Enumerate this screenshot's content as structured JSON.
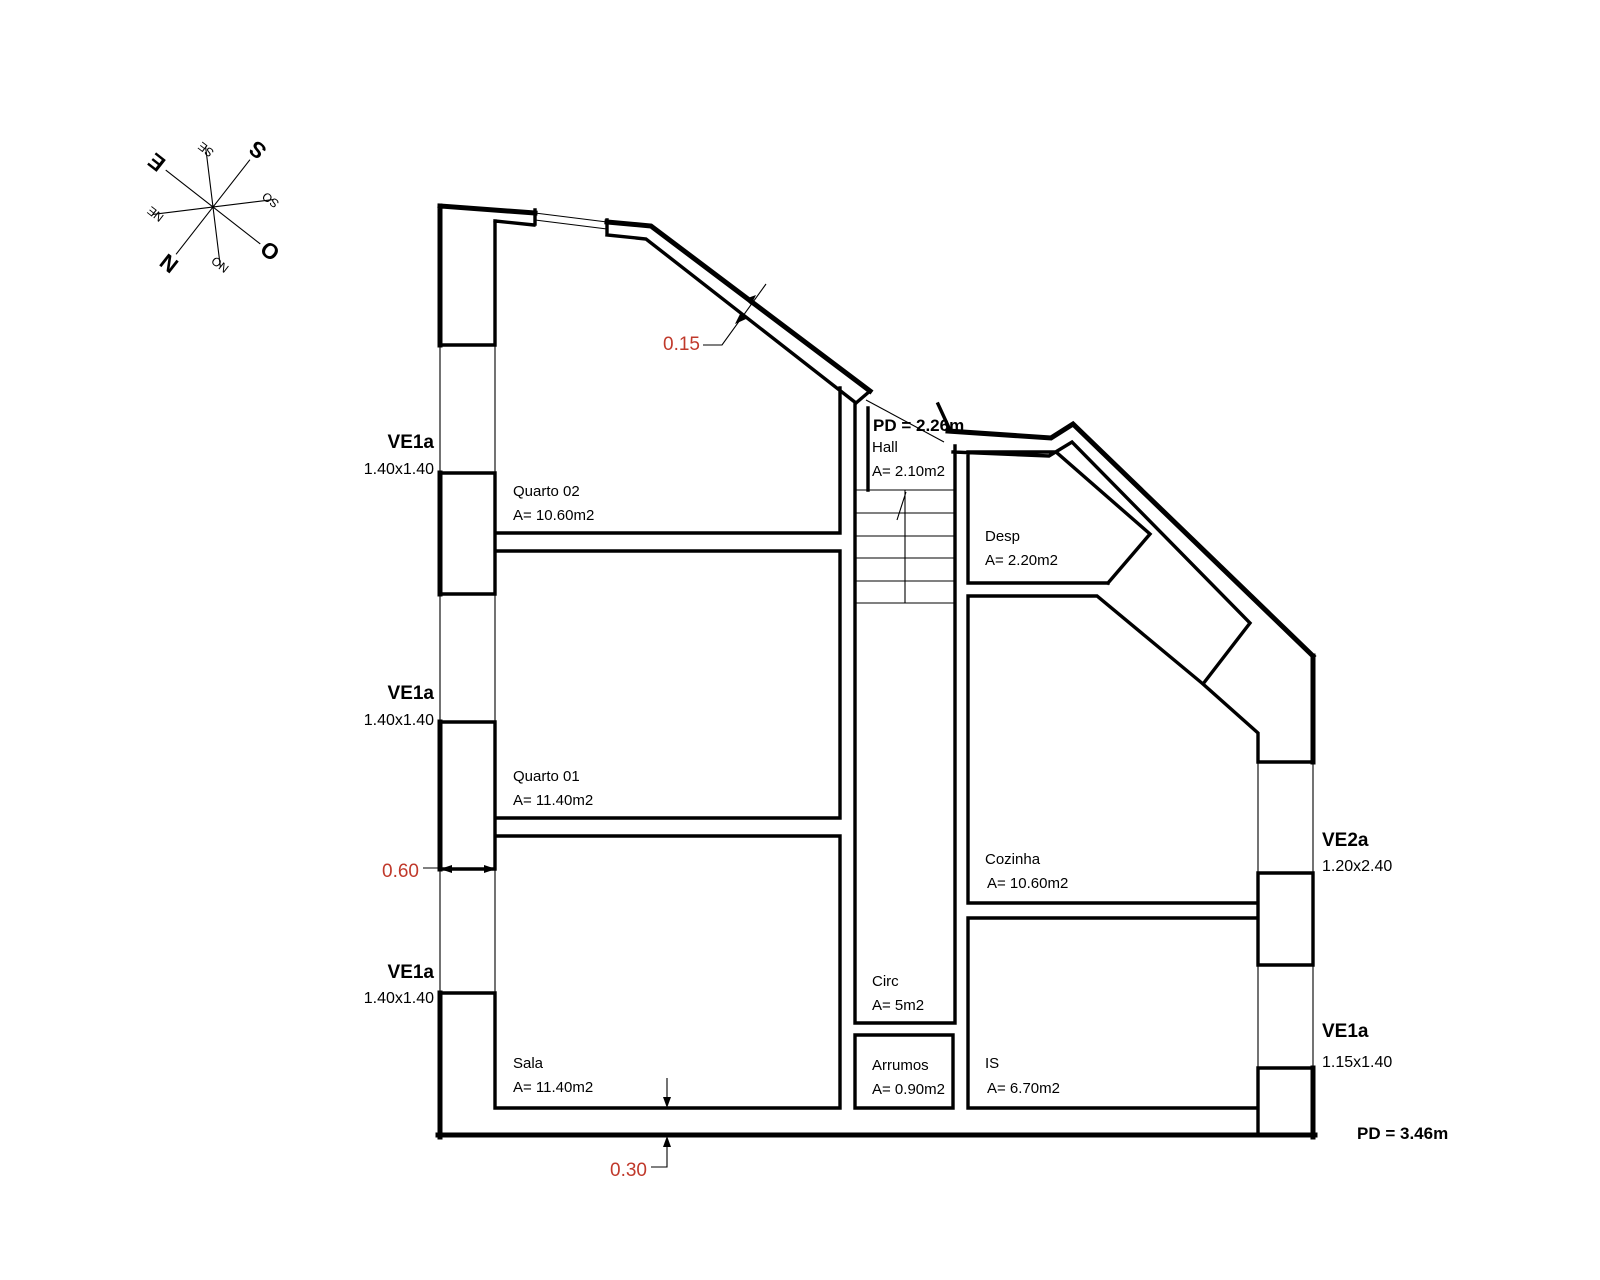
{
  "compass": {
    "n": "N",
    "ne": "NE",
    "e": "E",
    "se": "SE",
    "s": "S",
    "so": "SO",
    "o": "O",
    "no": "NO"
  },
  "rooms": [
    {
      "id": "quarto-02",
      "name": "Quarto 02",
      "area": "A= 10.60m2"
    },
    {
      "id": "quarto-01",
      "name": "Quarto 01",
      "area": "A= 11.40m2"
    },
    {
      "id": "sala",
      "name": "Sala",
      "area": "A= 11.40m2"
    },
    {
      "id": "hall",
      "name": "Hall",
      "area": "A= 2.10m2"
    },
    {
      "id": "desp",
      "name": "Desp",
      "area": "A= 2.20m2"
    },
    {
      "id": "cozinha",
      "name": "Cozinha",
      "area": "A= 10.60m2"
    },
    {
      "id": "circ",
      "name": "Circ",
      "area": "A= 5m2"
    },
    {
      "id": "arrumos",
      "name": "Arrumos",
      "area": "A= 0.90m2"
    },
    {
      "id": "is",
      "name": "IS",
      "area": "A= 6.70m2"
    }
  ],
  "windows": [
    {
      "code": "VE1a",
      "size": "1.40x1.40",
      "wall": "left"
    },
    {
      "code": "VE1a",
      "size": "1.40x1.40",
      "wall": "left"
    },
    {
      "code": "VE1a",
      "size": "1.40x1.40",
      "wall": "left"
    },
    {
      "code": "VE2a",
      "size": "1.20x2.40",
      "wall": "right"
    },
    {
      "code": "VE1a",
      "size": "1.15x1.40",
      "wall": "right"
    }
  ],
  "ceiling_heights": [
    {
      "label": "PD = 2.26m"
    },
    {
      "label": "PD = 3.46m"
    }
  ],
  "wall_dimensions": [
    {
      "value": "0.15"
    },
    {
      "value": "0.60"
    },
    {
      "value": "0.30"
    }
  ],
  "colors": {
    "line": "#000000",
    "dimension_red": "#c0392b",
    "background": "#ffffff"
  }
}
